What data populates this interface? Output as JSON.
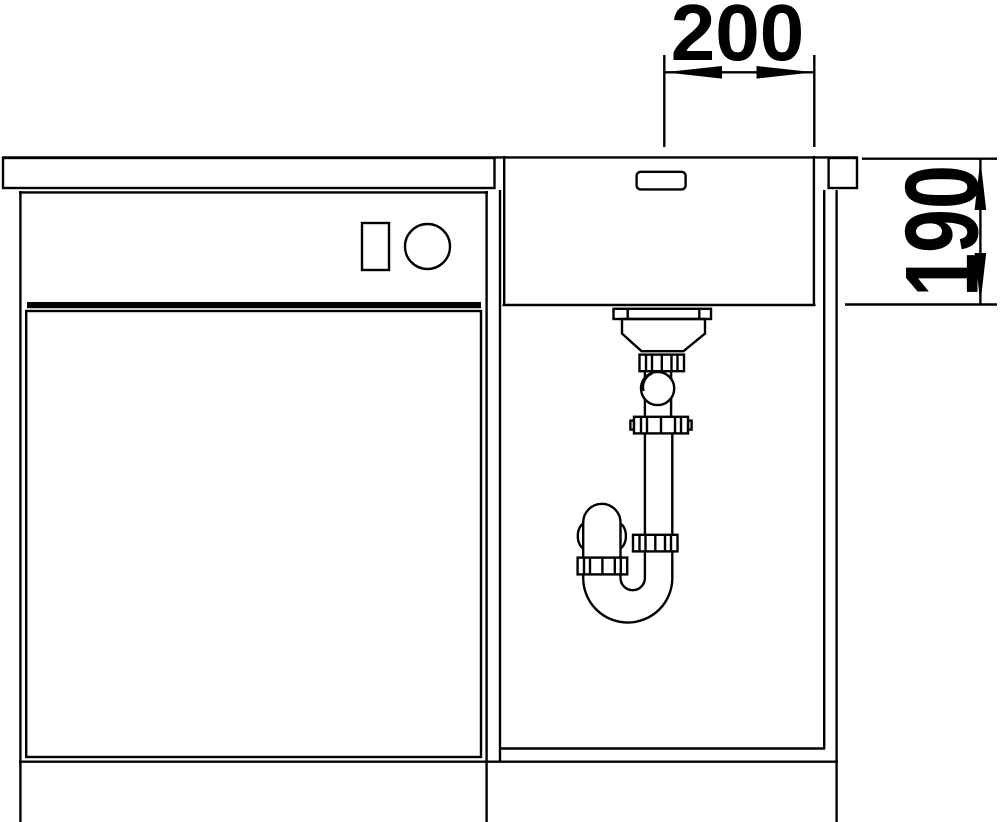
{
  "drawing": {
    "dimension_labels": {
      "top": "200",
      "right": "190"
    },
    "colors": {
      "line": "#000000",
      "background": "#ffffff"
    }
  }
}
